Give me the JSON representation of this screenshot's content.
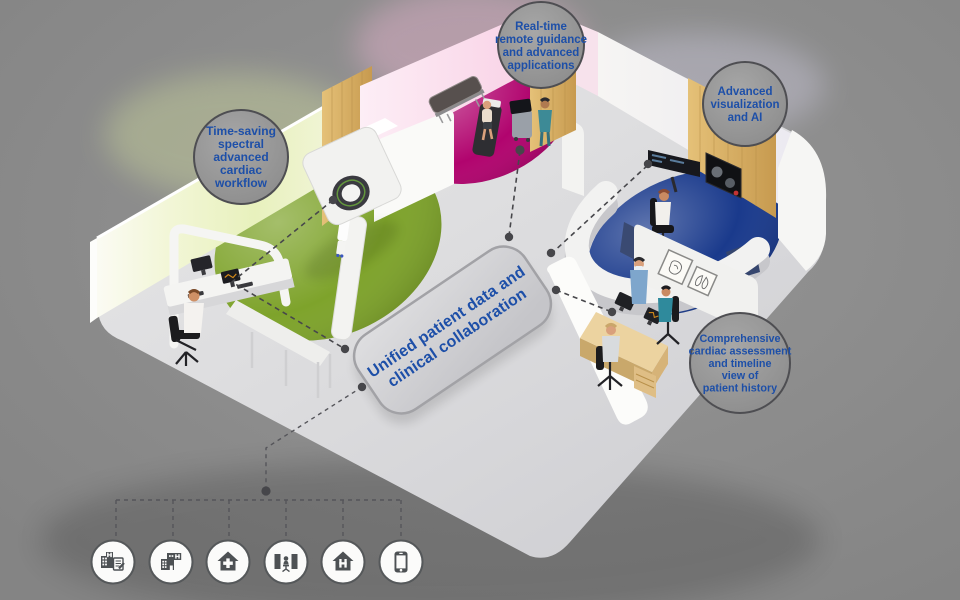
{
  "callouts": {
    "ct_workflow": {
      "lines": [
        "Time-saving",
        "spectral",
        "advanced",
        "cardiac",
        "workflow"
      ]
    },
    "remote_guidance": {
      "lines": [
        "Real-time",
        "remote guidance",
        "and advanced",
        "applications"
      ]
    },
    "advanced_visualization": {
      "lines": [
        "Advanced",
        "visualization",
        "and AI"
      ]
    },
    "cardiac_assessment": {
      "lines": [
        "Comprehensive",
        "cardiac assessment",
        "and timeline",
        "view of",
        "patient history"
      ]
    }
  },
  "platform": {
    "lines": [
      "Unified patient data and",
      "clinical collaboration"
    ]
  },
  "facility_icons": [
    {
      "name": "hospital-with-report-icon"
    },
    {
      "name": "hospital-icon"
    },
    {
      "name": "clinic-home-plus-icon"
    },
    {
      "name": "imaging-workstation-icon"
    },
    {
      "name": "home-hospital-icon"
    },
    {
      "name": "mobile-phone-icon"
    }
  ],
  "colors": {
    "text_blue": "#1d4fa8",
    "green_floor": "#7ea32b",
    "magenta_floor": "#b1046e",
    "navy_floor": "#1a3a8c",
    "wood": "#d9b269",
    "background_gray": "#8e8e8e",
    "bubble_fill": "#9c9c9c",
    "line_gray": "#47474b"
  }
}
